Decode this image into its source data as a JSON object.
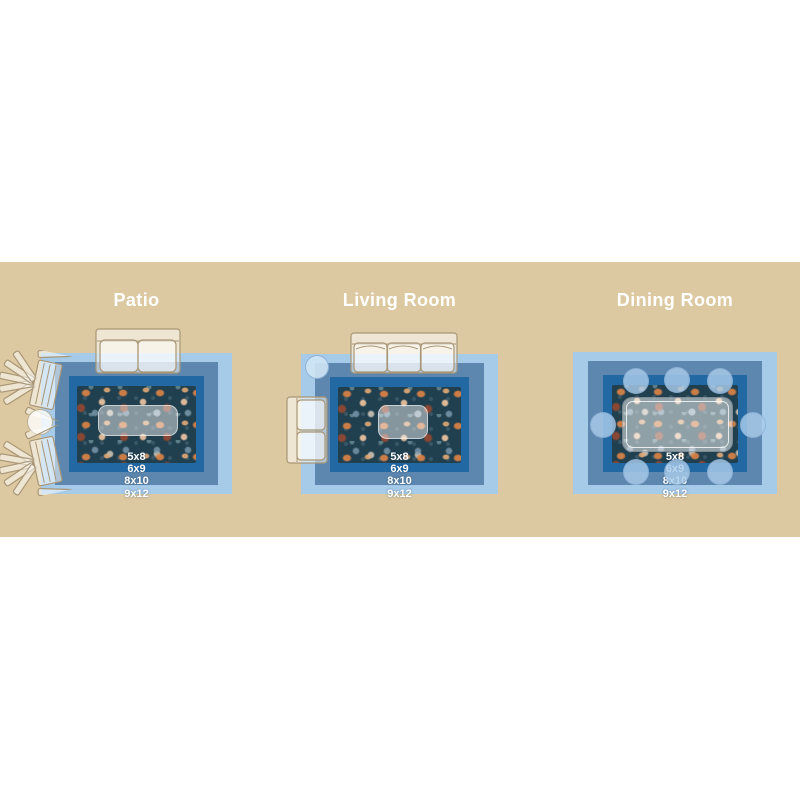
{
  "palette": {
    "band": "#dcc9a1",
    "size_9x12": "#a6cbe9",
    "size_8x10": "#5d87ae",
    "size_6x9": "#2269a4",
    "rug_field": "#21404f",
    "title_text": "#ffffff",
    "label_text": "#ffffff"
  },
  "size_labels": [
    "5x8",
    "6x9",
    "8x10",
    "9x12"
  ],
  "rooms": [
    {
      "title": "Patio",
      "furniture_icons": [
        "outdoor-loveseat-icon",
        "adirondack-chair-icon",
        "round-patio-table-icon",
        "adirondack-chair-icon",
        "coffee-table-icon"
      ]
    },
    {
      "title": "Living Room",
      "furniture_icons": [
        "sofa-icon",
        "round-side-table-icon",
        "armchair-icon",
        "coffee-table-icon"
      ]
    },
    {
      "title": "Dining Room",
      "furniture_icons": [
        "dining-table-icon",
        "dining-chair-icon"
      ]
    }
  ]
}
